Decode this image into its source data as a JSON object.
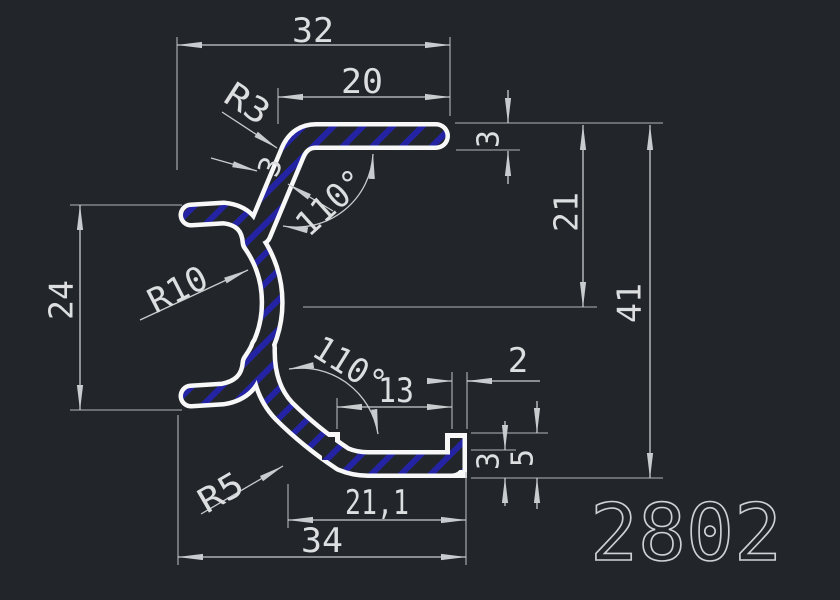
{
  "app": {
    "type": "cad-drawing-viewport",
    "background_color": "#22262b",
    "profile_line_color": "#f8f8f8",
    "hatch_color": "#2323a4",
    "dimension_color": "#c9ccce"
  },
  "drawing": {
    "part_number": "2802",
    "dims": {
      "overall_width": "32",
      "top_arm_length": "20",
      "top_arm_thickness": "3",
      "top_fillet": "R3",
      "web_thickness": "3",
      "top_angle": "110°",
      "mid_depth": "21",
      "overall_height": "41",
      "left_opening_height": "24",
      "channel_radius": "R10",
      "bottom_angle": "110°",
      "notch_to_tab": "13",
      "tab_width": "2",
      "bottom_arm_thickness": "3",
      "tab_height": "5",
      "bottom_fillet": "R5",
      "bottom_inner_length": "21,1",
      "bottom_width": "34"
    }
  }
}
